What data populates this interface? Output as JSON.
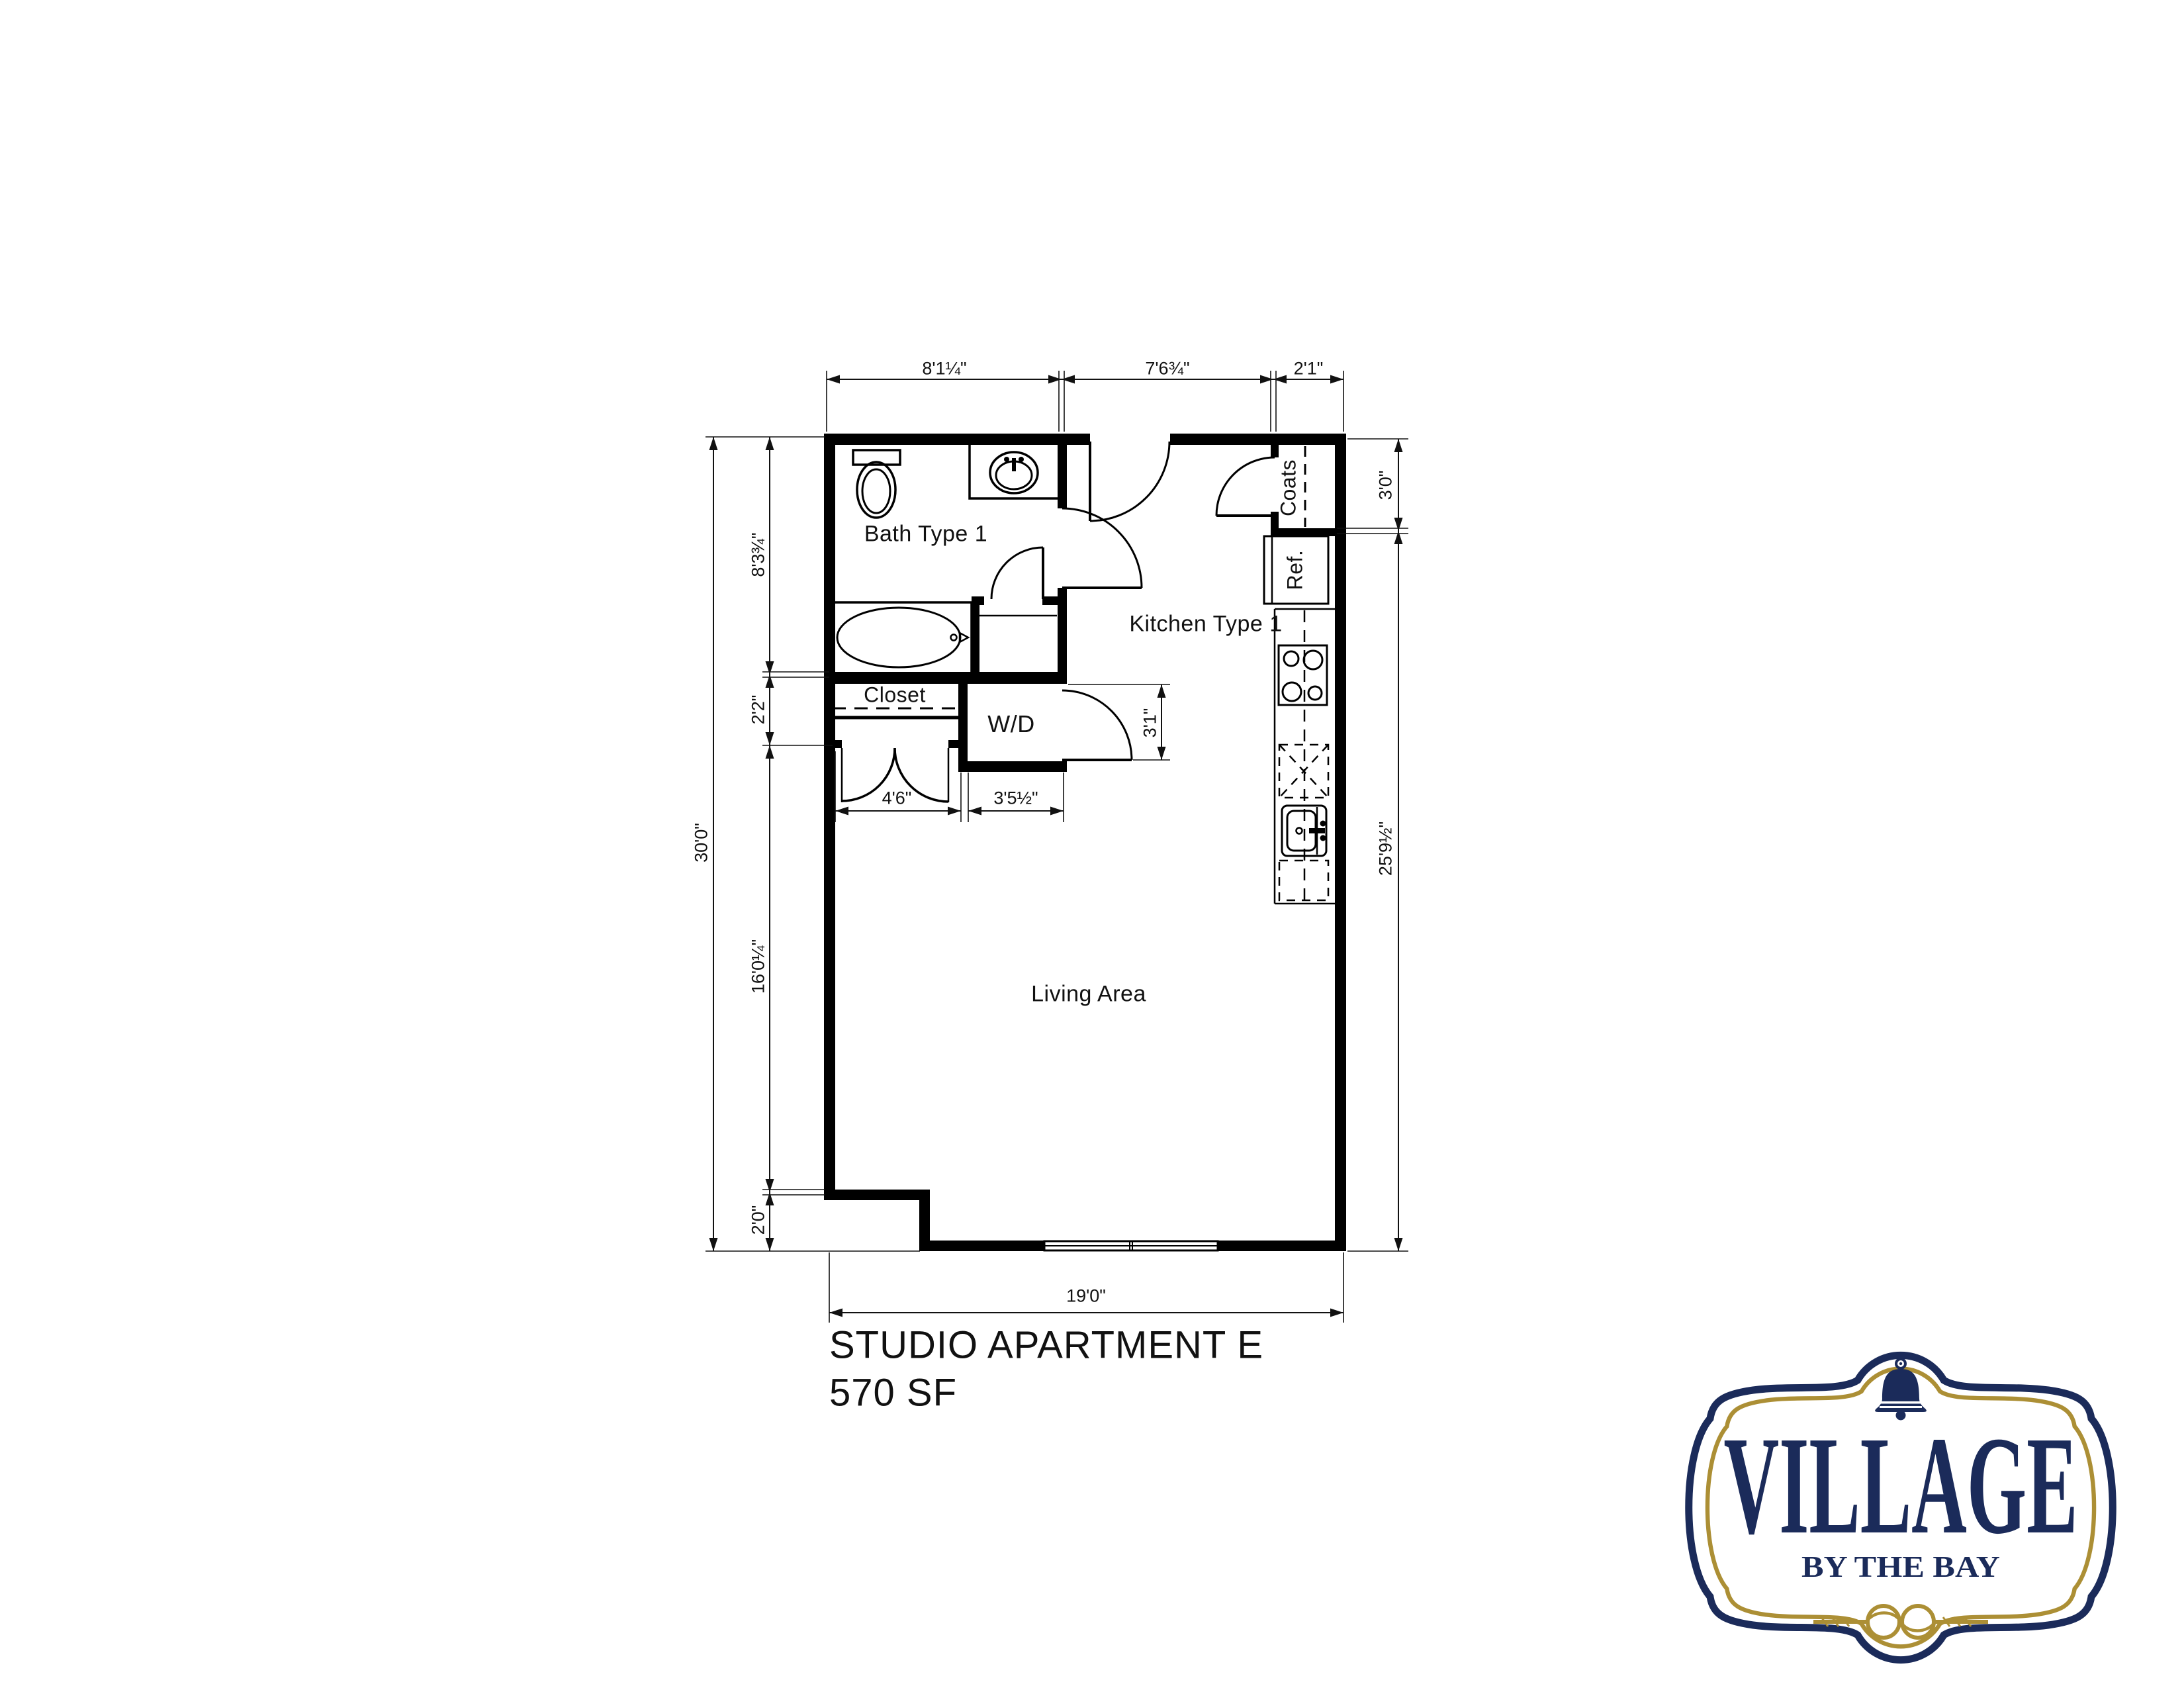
{
  "plan": {
    "title": "STUDIO APARTMENT E",
    "area": "570 SF",
    "rooms": {
      "bath": "Bath Type 1",
      "kitchen": "Kitchen Type 1",
      "closet": "Closet",
      "living": "Living Area"
    },
    "fixtures": {
      "washer_dryer": "W/D",
      "coats": "Coats",
      "refrigerator": "Ref."
    },
    "dimensions": {
      "top": [
        "8'1¼\"",
        "7'6¾\"",
        "2'1\""
      ],
      "left_overall": "30'0\"",
      "left_chain": [
        "8'3¾\"",
        "2'2\"",
        "16'0¼\"",
        "2'0\""
      ],
      "right_chain": [
        "3'0\"",
        "25'9½\""
      ],
      "bottom_overall": "19'0\"",
      "closet_opening": "4'6\"",
      "wd_closet_width": "3'5½\"",
      "wd_closet_depth": "3'1\""
    }
  },
  "logo": {
    "name": "VILLAGE",
    "tagline": "BY THE BAY",
    "icons": [
      "bell-icon",
      "rope-knot-icon"
    ],
    "colors": {
      "navy": "#1b2b5a",
      "gold": "#ac8f35"
    }
  }
}
